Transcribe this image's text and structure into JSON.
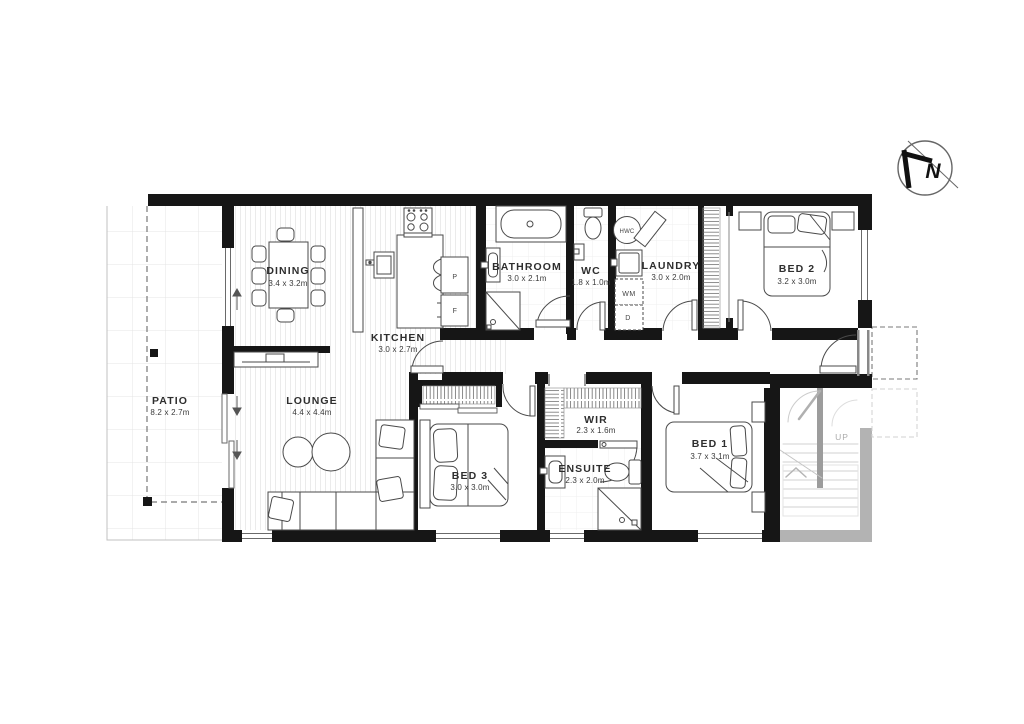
{
  "rooms": {
    "dining": {
      "name": "DINING",
      "dims": "3.4 x 3.2m"
    },
    "kitchen": {
      "name": "KITCHEN",
      "dims": "3.0 x 2.7m"
    },
    "bathroom": {
      "name": "BATHROOM",
      "dims": "3.0 x 2.1m"
    },
    "wc": {
      "name": "WC",
      "dims": "1.8 x 1.0m"
    },
    "laundry": {
      "name": "LAUNDRY",
      "dims": "3.0 x 2.0m"
    },
    "bed2": {
      "name": "BED 2",
      "dims": "3.2 x 3.0m"
    },
    "patio": {
      "name": "PATIO",
      "dims": "8.2 x 2.7m"
    },
    "lounge": {
      "name": "LOUNGE",
      "dims": "4.4 x 4.4m"
    },
    "bed3": {
      "name": "BED 3",
      "dims": "3.0 x 3.0m"
    },
    "wir": {
      "name": "WIR",
      "dims": "2.3 x 1.6m"
    },
    "ensuite": {
      "name": "ENSUITE",
      "dims": "2.3 x 2.0m"
    },
    "bed1": {
      "name": "BED 1",
      "dims": "3.7 x 3.1m"
    }
  },
  "labels": {
    "hwc": "HWC",
    "washing_machine": "WM",
    "dryer": "D",
    "pantry": "P",
    "fridge": "F",
    "stairs_up": "UP",
    "compass_north": "N"
  },
  "colors": {
    "wall": "#161616",
    "furniture_line": "#4a4a4a",
    "grey_structure": "#b3b3b3",
    "text": "#2e2e2e"
  }
}
